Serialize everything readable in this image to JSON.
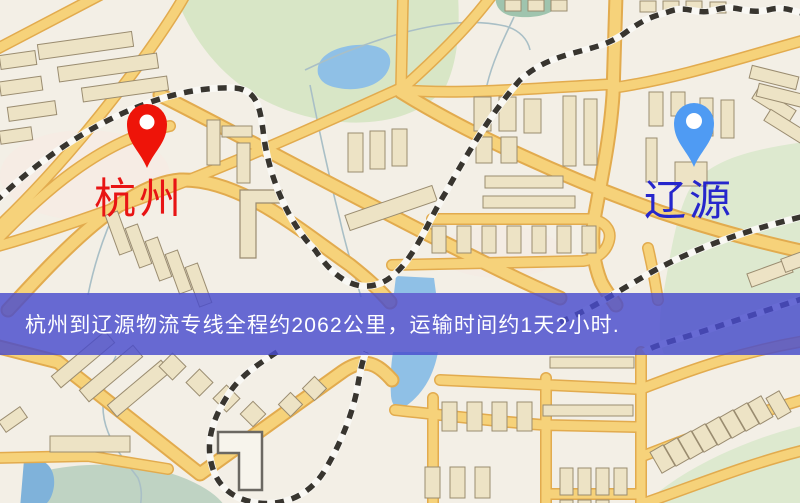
{
  "map": {
    "kind": "road-map",
    "markers": {
      "origin": {
        "label": "杭州",
        "pin_color": "#ee1409",
        "label_color": "#e81414",
        "pin_style": "red-teardrop-pin"
      },
      "destination": {
        "label": "辽源",
        "pin_color": "#4f9bf3",
        "label_color": "#2626cc",
        "pin_style": "blue-teardrop-pin"
      }
    },
    "palette": {
      "map_background": "#f3efe6",
      "road": "#f6d27a",
      "road_casing": "#e2ab4e",
      "building": "#ede3c5",
      "building_outline": "#9a8c70",
      "park": "#d8e6c6",
      "water": "#8fc0e6",
      "railway": "#38352f"
    }
  },
  "banner": {
    "text": "杭州到辽源物流专线全程约2062公里，运输时间约1天2小时.",
    "overlay_color": "rgba(72,76,205,0.82)",
    "text_color": "#ffffff",
    "route": {
      "origin": "杭州",
      "destination": "辽源",
      "service": "物流专线",
      "distance": "约2062公里",
      "duration": "约1天2小时"
    }
  }
}
